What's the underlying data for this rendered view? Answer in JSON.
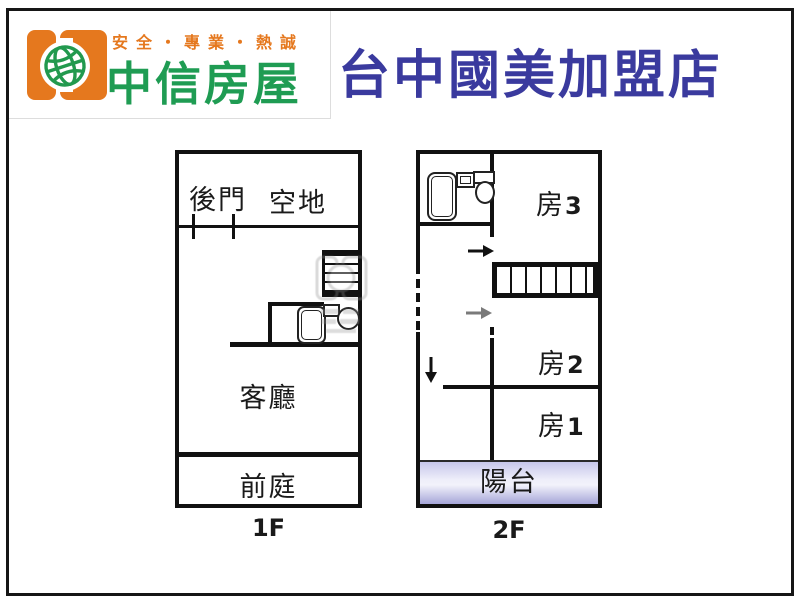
{
  "header": {
    "brand": {
      "tagline": "安全・專業・熱誠",
      "name": "中信房屋",
      "logo_icon": "double-door-globe-logo",
      "orange": "#e5781e",
      "green": "#1f9c53"
    },
    "title": "台中國美加盟店",
    "title_color": "#3a3a9e"
  },
  "floor1": {
    "label": "1F",
    "room_backdoor": "後門",
    "room_openspace": "空地",
    "room_living": "客廳",
    "room_frontyard": "前庭",
    "features": [
      "staircase",
      "bathtub",
      "toilet",
      "door-ticks"
    ]
  },
  "floor2": {
    "label": "2F",
    "room3_prefix": "房",
    "room3_num": "3",
    "room2_prefix": "房",
    "room2_num": "2",
    "room1_prefix": "房",
    "room1_num": "1",
    "room_balcony": "陽台",
    "features": [
      "staircase",
      "bathtub",
      "sink",
      "toilet",
      "up-arrow",
      "down-arrow",
      "dashed-wall"
    ]
  },
  "colors": {
    "wall": "#111111",
    "balcony_top": "#c7c7ea",
    "balcony_bottom": "#a6a6d8",
    "arrow_black": "#111111",
    "arrow_grey": "#7a7a7a",
    "watermark_grey": "#8b8b8b"
  }
}
